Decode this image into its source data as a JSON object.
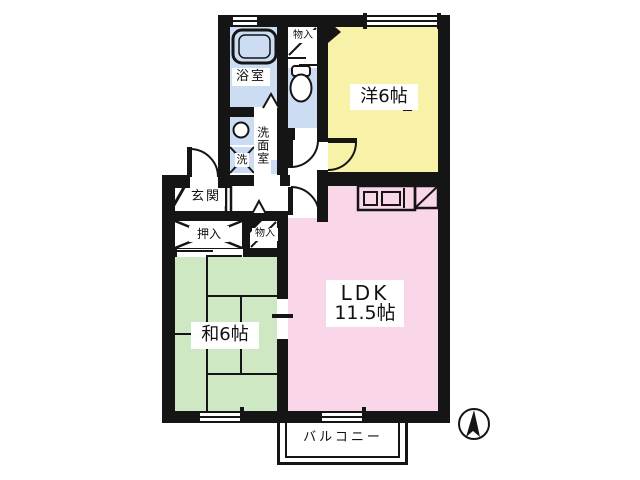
{
  "floorplan": {
    "rooms": {
      "western_room": {
        "label": "洋6帖"
      },
      "ldk": {
        "label": "LDK",
        "size": "11.5帖"
      },
      "japanese_room": {
        "label": "和6帖"
      },
      "bathroom": {
        "label": "浴室"
      },
      "washroom": {
        "label": "洗面室"
      },
      "washing_machine": {
        "label": "洗"
      },
      "toilet": {
        "label": ""
      },
      "entrance": {
        "label": "玄関"
      },
      "closet": {
        "label": "押入"
      },
      "storage_top": {
        "label": "物入"
      },
      "storage_middle": {
        "label": "物入"
      },
      "balcony": {
        "label": "バルコニー"
      }
    },
    "colors": {
      "western_room": "#f8f2a8",
      "ldk": "#f9d7e9",
      "japanese_room": "#cfe8c4",
      "wet_area": "#ccdcf2",
      "wall": "#151515",
      "background": "#ffffff"
    },
    "icons": {
      "bathtub": "bathtub-icon",
      "toilet": "toilet-icon",
      "sink": "sink-circle-icon",
      "kitchen": "kitchen-counter-icon",
      "refrigerator": "refrigerator-diagonal-icon",
      "compass": "north-arrow-compass-icon"
    }
  }
}
